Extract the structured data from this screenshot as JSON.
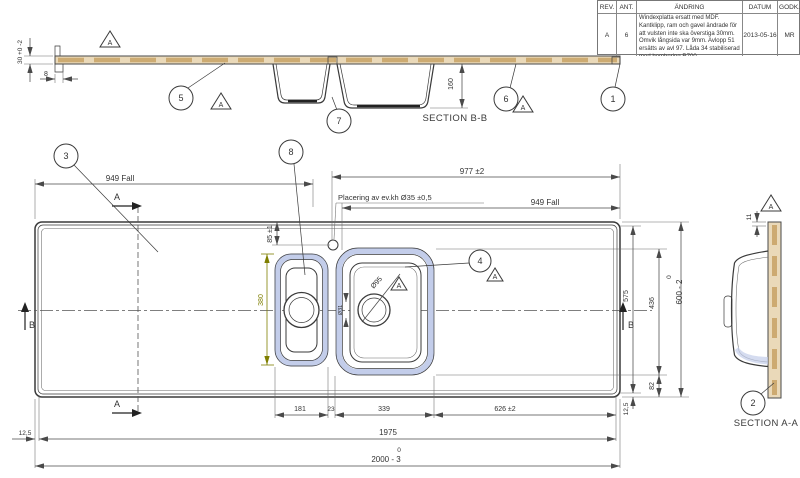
{
  "revision_table": {
    "headers": {
      "rev": "REV.",
      "ant": "ANT.",
      "andring": "ÄNDRING",
      "datum": "DATUM",
      "godk": "GODK."
    },
    "row": {
      "rev": "A",
      "ant": "6",
      "andring": "Windexplatta ersatt med MDF. Kantklipp, ram och gavel ändrade för att vulsten inte ska överstiga 30mm. Omvik långsida var 9mm. Avlopp 51 ersätts av avl 97. Låda 34 stabiliserad med bombering R700.",
      "datum": "2013-05-16",
      "godk": "MR"
    }
  },
  "datum_flag": "A",
  "balloons": {
    "b1": "1",
    "b2": "2",
    "b3": "3",
    "b4": "4",
    "b5": "5",
    "b6": "6",
    "b7": "7",
    "b8": "8"
  },
  "section_marks": {
    "a": "A",
    "b": "B"
  },
  "section_bb": {
    "label": "SECTION B-B",
    "dim_front_height": "30 +0 -2",
    "dim_fold": "8",
    "dim_bowl_depth": "160"
  },
  "plan": {
    "dim_fall_left": "949 Fall",
    "dim_fall_right": "949 Fall",
    "dim_hole_from_right": "977 ±2",
    "hole_note": "Placering av ev.kh  Ø35 ±0,5",
    "dim_hole_from_edge": "85 ±1",
    "dim_small_bowl_length": "380",
    "dim_drain": "Ø95",
    "dim_overflow": "Ø31",
    "chain": {
      "c1": "181",
      "c2": "23",
      "c3": "339",
      "c4": "626 ±2"
    },
    "dim_flat_length": "1975",
    "length_tol_upper": "0",
    "dim_total_length": "2000 - 3",
    "dim_corner_left": "12,5",
    "dim_flat_depth": "575",
    "dim_bowl_outer_length": "436",
    "dim_bowl_to_edge": "82",
    "depth_tol_upper": "0",
    "dim_total_depth": "600 - 2",
    "dim_corner_bottom": "12,5"
  },
  "section_aa": {
    "label": "SECTION A-A",
    "dim_lip": "11"
  },
  "colors": {
    "line": "#3a3a3a",
    "dim": "#4a4a4a",
    "wood": "#ead9b9",
    "wood_dark": "#c8a265",
    "bowl_highlight": "#c3cdea",
    "olive_dim": "#7f7f00",
    "background": "#ffffff"
  }
}
